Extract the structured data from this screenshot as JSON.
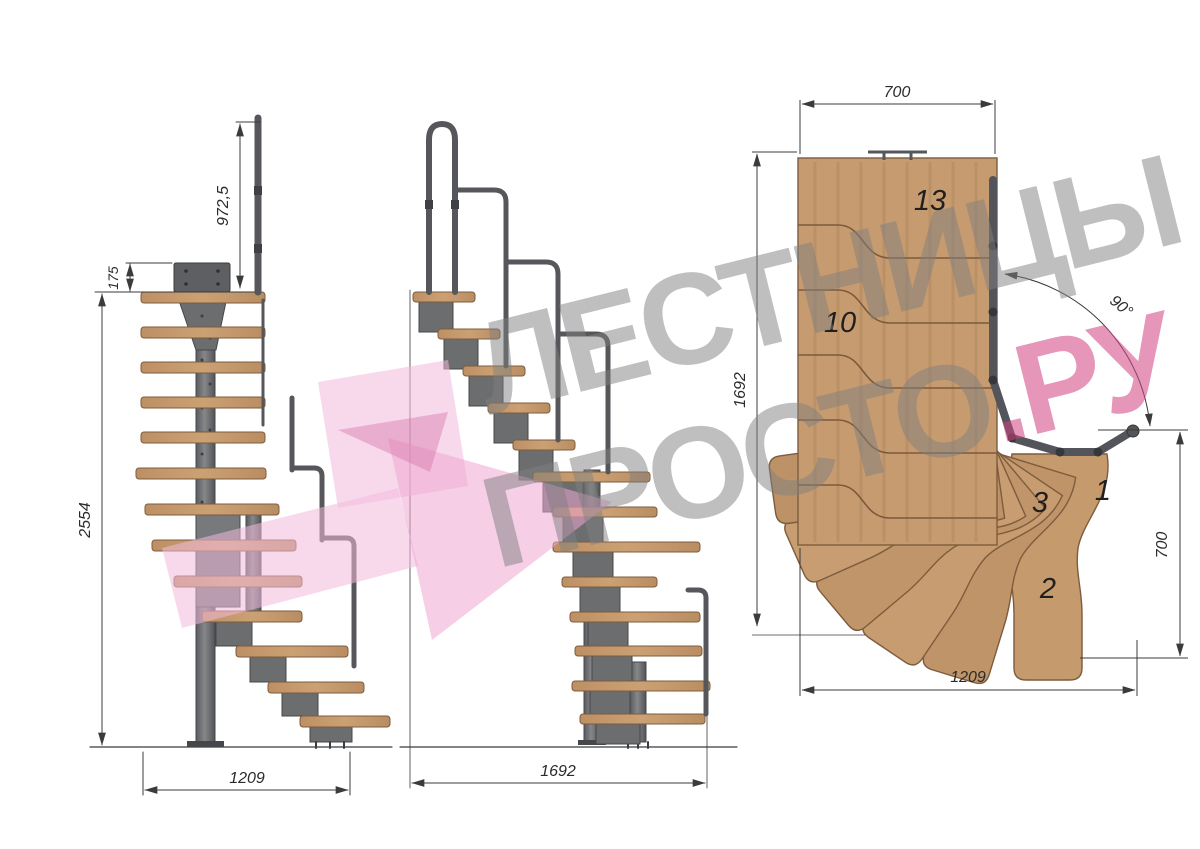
{
  "watermark": {
    "line1": "ЛЕСТНИЦЫ",
    "line2_gray": "ПРОСТО",
    "line2_pink": ".РУ"
  },
  "front_view": {
    "rail_height": "972,5",
    "plate_offset": "175",
    "total_height": "2554",
    "width": "1209"
  },
  "side_view": {
    "length": "1692"
  },
  "plan_view": {
    "top_width": "700",
    "left_length": "1692",
    "angle": "90°",
    "right_width": "700",
    "bottom_length": "1209",
    "step_13": "13",
    "step_10": "10",
    "step_3": "3",
    "step_2": "2",
    "step_1": "1"
  },
  "colors": {
    "wood": "#c49a6e",
    "wood_edge": "#7d5c3e",
    "metal": "#6b6d6f",
    "metal_dark": "#45474a",
    "dim_lines": "#3b3b3b",
    "watermark_gray": "#8a8a8a",
    "watermark_pink": "#cf3f7f",
    "logo_pink": "#f3b9dc"
  }
}
